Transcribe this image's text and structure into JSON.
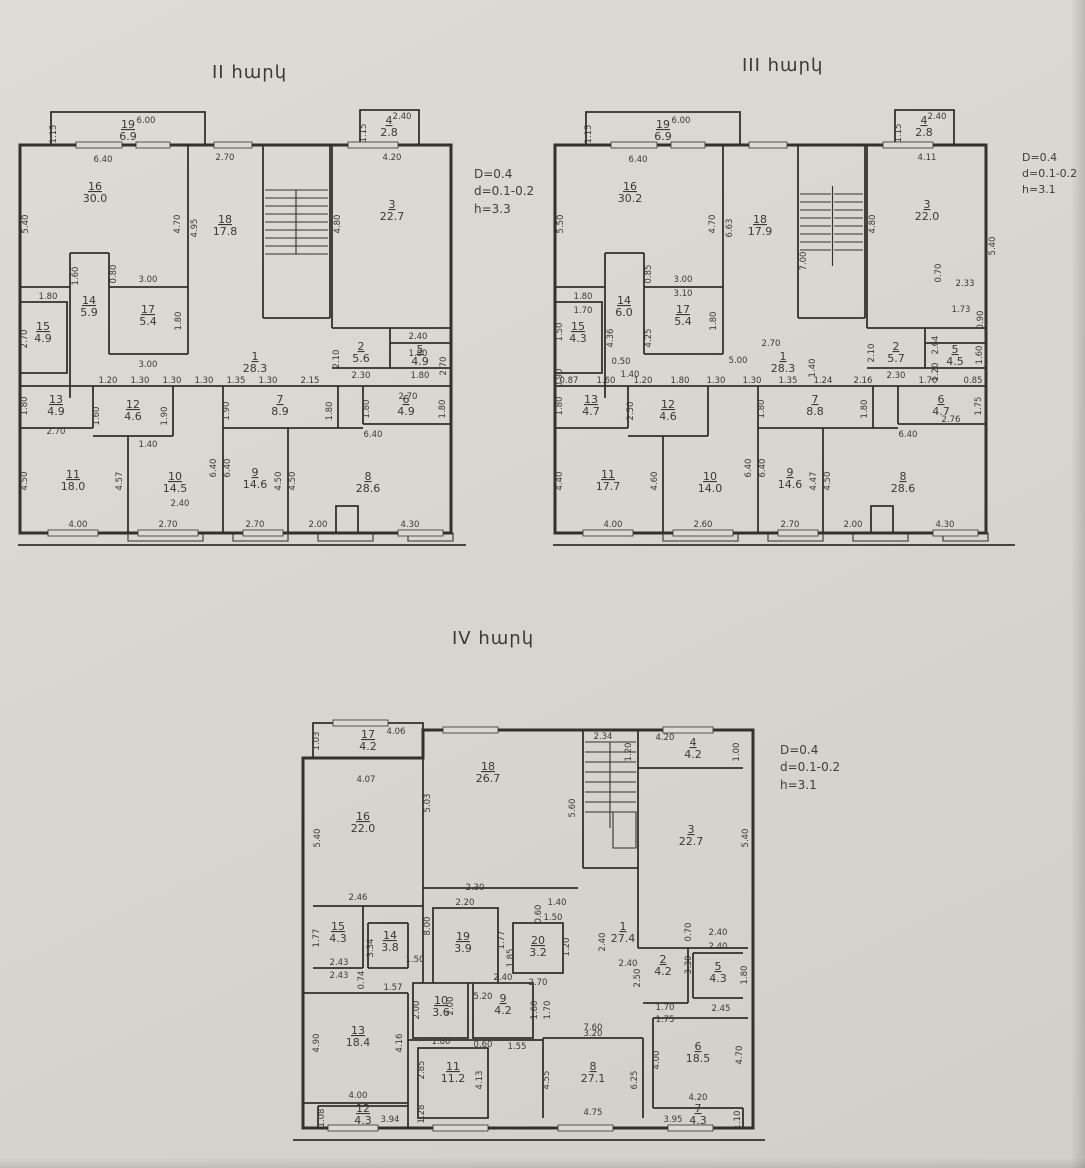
{
  "floors": {
    "f2": {
      "title": "II հարկ",
      "ann": [
        "D=0.4",
        "d=0.1-0.2",
        "h=3.3"
      ],
      "rooms": {
        "r1": {
          "n": "1",
          "a": "28.3"
        },
        "r2": {
          "n": "2",
          "a": "5.6"
        },
        "r3": {
          "n": "3",
          "a": "22.7"
        },
        "r4": {
          "n": "4",
          "a": "2.8"
        },
        "r5": {
          "n": "5",
          "a": "4.9"
        },
        "r6": {
          "n": "6",
          "a": "4.9"
        },
        "r7": {
          "n": "7",
          "a": "8.9"
        },
        "r8": {
          "n": "8",
          "a": "28.6"
        },
        "r9": {
          "n": "9",
          "a": "14.6"
        },
        "r10": {
          "n": "10",
          "a": "14.5"
        },
        "r11": {
          "n": "11",
          "a": "18.0"
        },
        "r12": {
          "n": "12",
          "a": "4.6"
        },
        "r13": {
          "n": "13",
          "a": "4.9"
        },
        "r14": {
          "n": "14",
          "a": "5.9"
        },
        "r15": {
          "n": "15",
          "a": "4.9"
        },
        "r16": {
          "n": "16",
          "a": "30.0"
        },
        "r17": {
          "n": "17",
          "a": "5.4"
        },
        "r18": {
          "n": "18",
          "a": "17.8"
        },
        "r19": {
          "n": "19",
          "a": "6.9"
        }
      },
      "dims": [
        "6.00",
        "1.15",
        "2.40",
        "1.15",
        "6.40",
        "2.70",
        "4.20",
        "5.40",
        "4.70",
        "4.95",
        "4.80",
        "1.80",
        "1.60",
        "0.80",
        "3.00",
        "1.80",
        "3.00",
        "2.70",
        "2.10",
        "2.40",
        "1.80",
        "2.70",
        "2.30",
        "1.80",
        "1.20",
        "1.30",
        "1.30",
        "1.30",
        "1.35",
        "1.30",
        "2.15",
        "2.70",
        "1.80",
        "2.70",
        "1.60",
        "1.90",
        "1.40",
        "1.90",
        "1.80",
        "1.80",
        "1.80",
        "6.40",
        "4.50",
        "4.00",
        "4.57",
        "6.40",
        "2.40",
        "2.70",
        "6.40",
        "4.50",
        "2.70",
        "4.50",
        "2.00",
        "4.30"
      ]
    },
    "f3": {
      "title": "III հարկ",
      "ann": [
        "D=0.4",
        "d=0.1-0.2",
        "h=3.1"
      ],
      "rooms": {
        "r1": {
          "n": "1",
          "a": "28.3"
        },
        "r2": {
          "n": "2",
          "a": "5.7"
        },
        "r3": {
          "n": "3",
          "a": "22.0"
        },
        "r4": {
          "n": "4",
          "a": "2.8"
        },
        "r5": {
          "n": "5",
          "a": "4.5"
        },
        "r6": {
          "n": "6",
          "a": "4.7"
        },
        "r7": {
          "n": "7",
          "a": "8.8"
        },
        "r8": {
          "n": "8",
          "a": "28.6"
        },
        "r9": {
          "n": "9",
          "a": "14.6"
        },
        "r10": {
          "n": "10",
          "a": "14.0"
        },
        "r11": {
          "n": "11",
          "a": "17.7"
        },
        "r12": {
          "n": "12",
          "a": "4.6"
        },
        "r13": {
          "n": "13",
          "a": "4.7"
        },
        "r14": {
          "n": "14",
          "a": "6.0"
        },
        "r15": {
          "n": "15",
          "a": "4.3"
        },
        "r16": {
          "n": "16",
          "a": "30.2"
        },
        "r17": {
          "n": "17",
          "a": "5.4"
        },
        "r18": {
          "n": "18",
          "a": "17.9"
        },
        "r19": {
          "n": "19",
          "a": "6.9"
        }
      },
      "dims": [
        "6.00",
        "1.15",
        "2.40",
        "1.15",
        "6.40",
        "4.11",
        "5.50",
        "4.70",
        "6.63",
        "7.00",
        "4.80",
        "5.40",
        "1.80",
        "0.85",
        "3.00",
        "3.10",
        "1.80",
        "4.36",
        "4.25",
        "1.70",
        "1.50",
        "0.90",
        "0.50",
        "5.00",
        "1.40",
        "2.70",
        "1.40",
        "2.10",
        "0.70",
        "2.33",
        "1.73",
        "0.90",
        "2.64",
        "1.20",
        "1.60",
        "2.30",
        "0.87",
        "1.60",
        "1.20",
        "1.80",
        "1.30",
        "1.30",
        "1.35",
        "1.24",
        "2.16",
        "1.70",
        "0.85",
        "1.80",
        "2.50",
        "1.80",
        "1.80",
        "6.40",
        "2.76",
        "1.75",
        "4.40",
        "4.00",
        "4.60",
        "6.40",
        "2.60",
        "6.40",
        "4.47",
        "2.70",
        "4.50",
        "2.00",
        "4.30"
      ]
    },
    "f4": {
      "title": "IV հարկ",
      "ann": [
        "D=0.4",
        "d=0.1-0.2",
        "h=3.1"
      ],
      "rooms": {
        "r1": {
          "n": "1",
          "a": "27.4"
        },
        "r2": {
          "n": "2",
          "a": "4.2"
        },
        "r3": {
          "n": "3",
          "a": "22.7"
        },
        "r4": {
          "n": "4",
          "a": "4.2"
        },
        "r5": {
          "n": "5",
          "a": "4.3"
        },
        "r6": {
          "n": "6",
          "a": "18.5"
        },
        "r7": {
          "n": "7",
          "a": "4.3"
        },
        "r8": {
          "n": "8",
          "a": "27.1"
        },
        "r9": {
          "n": "9",
          "a": "4.2"
        },
        "r10": {
          "n": "10",
          "a": "3.6"
        },
        "r11": {
          "n": "11",
          "a": "11.2"
        },
        "r12": {
          "n": "12",
          "a": "4.3"
        },
        "r13": {
          "n": "13",
          "a": "18.4"
        },
        "r14": {
          "n": "14",
          "a": "3.8"
        },
        "r15": {
          "n": "15",
          "a": "4.3"
        },
        "r16": {
          "n": "16",
          "a": "22.0"
        },
        "r17": {
          "n": "17",
          "a": "4.2"
        },
        "r18": {
          "n": "18",
          "a": "26.7"
        },
        "r19": {
          "n": "19",
          "a": "3.9"
        },
        "r20": {
          "n": "20",
          "a": "3.2"
        }
      },
      "dims": [
        "1.03",
        "4.06",
        "4.07",
        "2.34",
        "1.20",
        "4.20",
        "1.00",
        "5.40",
        "5.03",
        "5.60",
        "8.00",
        "2.46",
        "2.30",
        "2.20",
        "1.77",
        "1.85",
        "0.60",
        "1.40",
        "1.50",
        "1.20",
        "2.70",
        "5.20",
        "2.40",
        "2.40",
        "5.40",
        "0.70",
        "1.77",
        "2.43",
        "2.43",
        "3.34",
        "1.50",
        "0.74",
        "1.57",
        "7.60",
        "2.50",
        "3.30",
        "1.70",
        "1.75",
        "2.40",
        "2.40",
        "1.80",
        "2.45",
        "2.00",
        "2.00",
        "1.80",
        "2.40",
        "1.60",
        "1.70",
        "1.55",
        "0.60",
        "3.20",
        "4.90",
        "4.16",
        "4.00",
        "1.08",
        "3.94",
        "2.85",
        "4.13",
        "1.28",
        "4.55",
        "6.25",
        "4.75",
        "4.00",
        "4.70",
        "4.20",
        "3.95",
        "1.10"
      ]
    }
  }
}
